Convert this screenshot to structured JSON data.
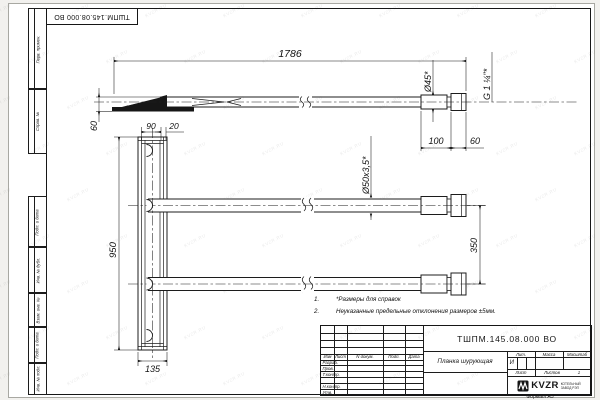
{
  "page": {
    "watermark": "KVZR.RU",
    "stamp_top": "ТШПМ.145.08.000 ВО",
    "format_label": "Формат А3"
  },
  "margin_labels": [
    "Перв. примен.",
    "Справ. №",
    "Подп. и дата",
    "Инв. № дубл.",
    "Взам. инв. №",
    "Подп. и дата",
    "Инв. № подл."
  ],
  "dims": {
    "total_length": "1786",
    "dia45": "Ø45*",
    "thread": "G 1 ¼\"*",
    "len100": "100",
    "len60": "60",
    "offset60": "60",
    "width90": "90",
    "width20": "20",
    "height950": "950",
    "spacing350": "350",
    "width135": "135",
    "tube_spec": "Ø50х3,5*"
  },
  "notes": {
    "n1_num": "1.",
    "n1_text": "*Размеры для справок",
    "n2_num": "2.",
    "n2_text": "Неуказанные предельные отклонения размеров ±5мм."
  },
  "title_block": {
    "doc_number": "ТШПМ.145.08.000 ВО",
    "part_name": "Планка шурующая",
    "col_izm": "Изм",
    "col_list": "Лист",
    "col_ndoc": "N докум.",
    "col_podp": "Подп.",
    "col_data": "Дата",
    "row_razrab": "Разраб.",
    "row_prov": "Пров.",
    "row_tkontr": "Т.контр.",
    "row_nkontr": "Н.контр.",
    "row_utv": "Утв.",
    "lit_header": "Лит.",
    "lit_value": "И",
    "massa_header": "Масса",
    "masshtab_header": "Масштаб",
    "list_label": "Лист",
    "listov_label": "Листов",
    "listov_value": "1",
    "logo_name": "KVZR",
    "logo_line1": "КОТЕЛЬНЫЙ",
    "logo_line2": "ЗАВОД РЭП"
  }
}
